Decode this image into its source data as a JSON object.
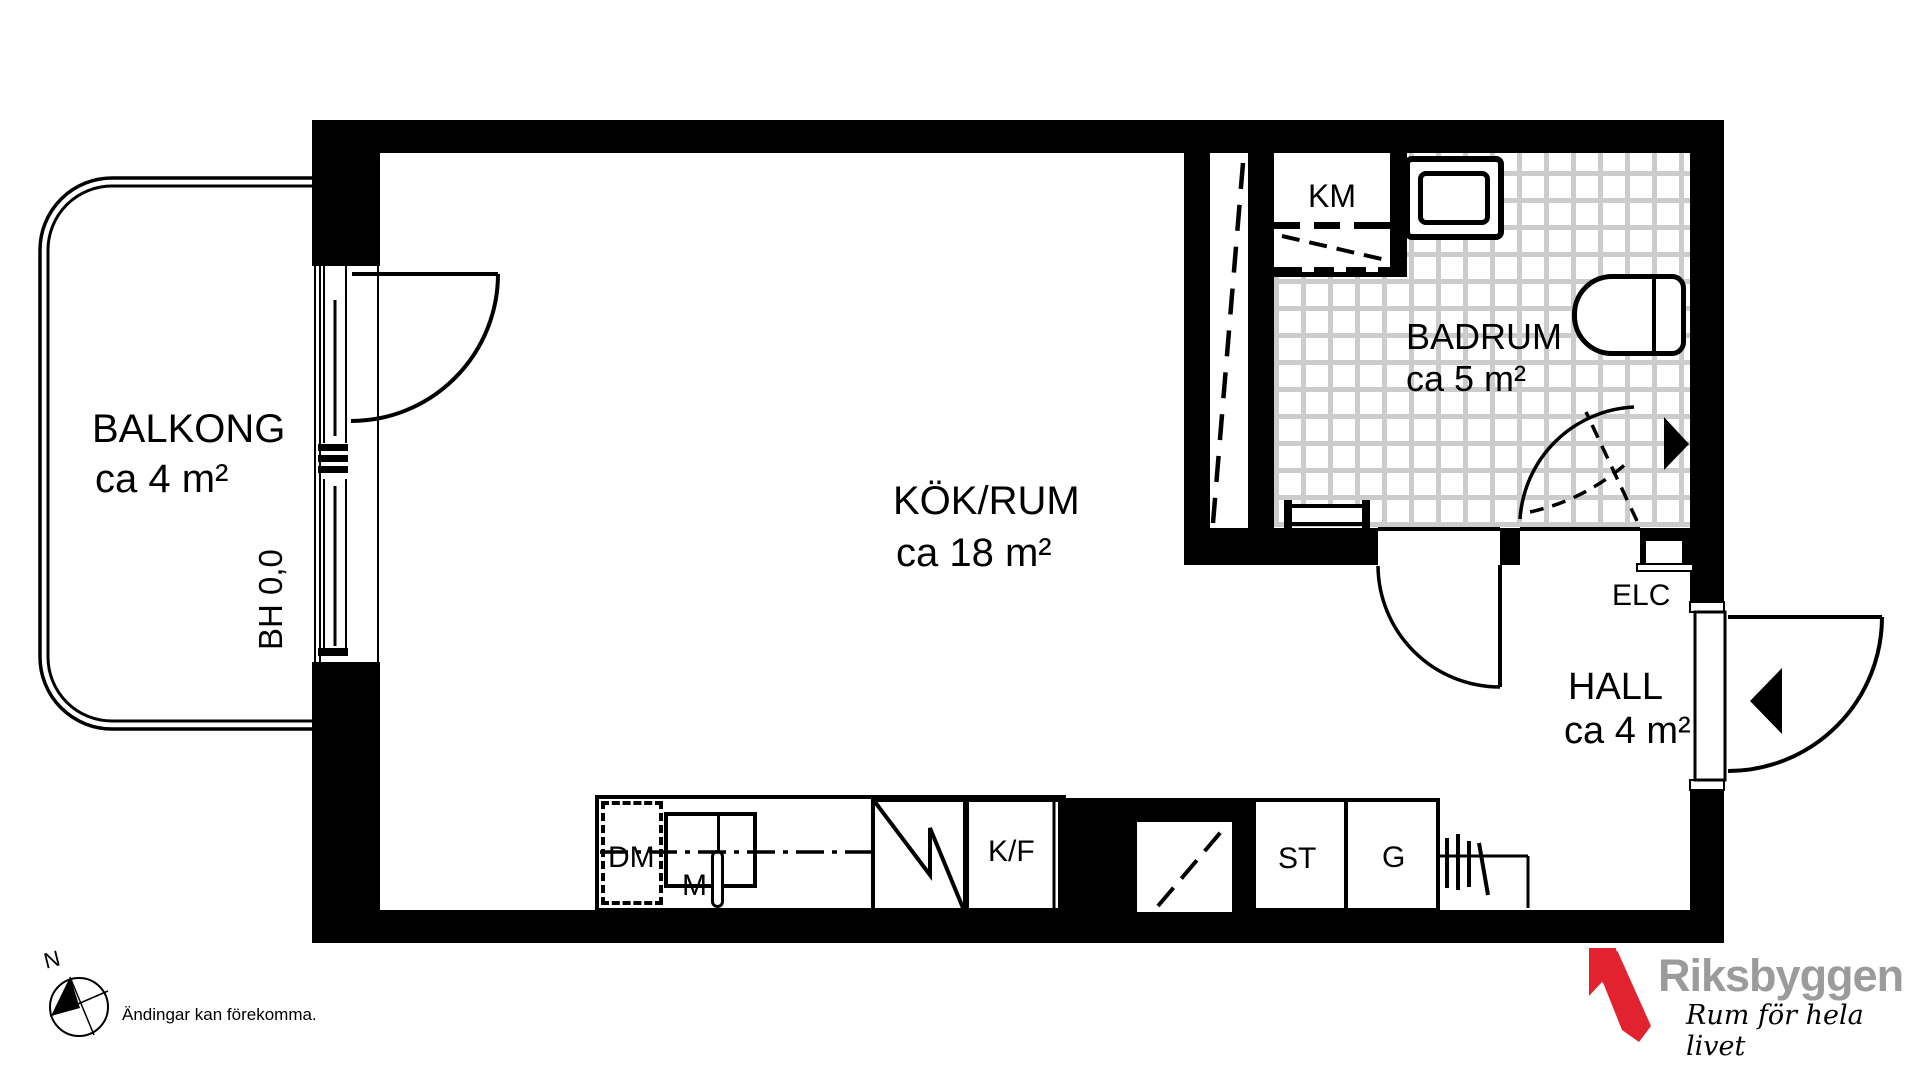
{
  "rooms": {
    "balcony": {
      "name": "BALKONG",
      "area": "ca 4 m²"
    },
    "kitchen_room": {
      "name": "KÖK/RUM",
      "area": "ca 18 m²"
    },
    "bathroom": {
      "name": "BADRUM",
      "area": "ca 5 m²"
    },
    "hall": {
      "name": "HALL",
      "area": "ca 4 m²"
    }
  },
  "annotations": {
    "balcony_height": "BH 0,0",
    "washing_machine": "KM",
    "electrical_cabinet": "ELC",
    "dishwasher": "DM",
    "sink_unit": "M",
    "fridge_freezer": "K/F",
    "cleaning_cabinet": "ST",
    "wardrobe": "G"
  },
  "compass": {
    "north_label": "N"
  },
  "disclaimer": "Ändingar kan förekomma.",
  "logo": {
    "brand": "Riksbyggen",
    "tagline": "Rum för hela livet"
  },
  "colors": {
    "wall": "#000000",
    "tile_grout": "#cccccc",
    "logo_red": "#e3222f",
    "logo_gray": "#9c9b9a"
  }
}
